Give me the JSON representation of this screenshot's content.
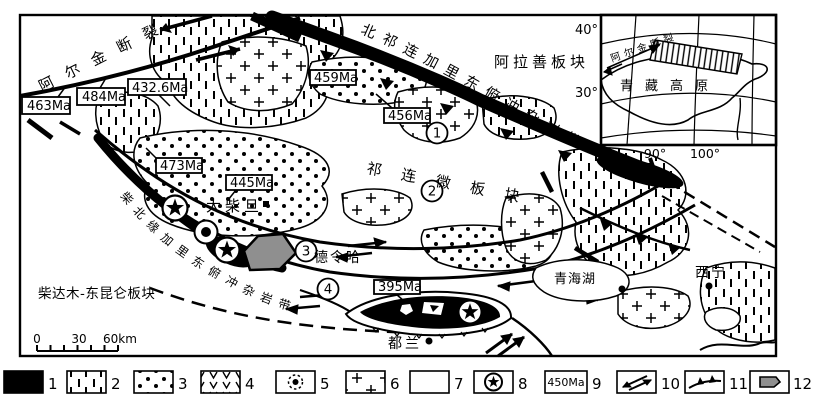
{
  "map": {
    "faults": {
      "altyn_label": "阿尔金断裂",
      "north_qilian_label": "北祁连加里东俯冲杂岩带",
      "north_qaidam_label": "柴北缘加里东俯冲杂岩带"
    },
    "plates": {
      "alxa": "阿拉善板块",
      "qilian": "祁连微板块",
      "qaidam_kunlun": "柴达木-东昆仑板块"
    },
    "places": {
      "da_qaidam": "大柴旦",
      "delingha": "德令哈",
      "dulan": "都兰",
      "xining": "西宁",
      "qinghai_lake": "青海湖"
    },
    "age_labels": {
      "a463": "463Ma",
      "a484": "484Ma",
      "a432_6": "432.6Ma",
      "a459": "459Ma",
      "a456": "456Ma",
      "a473": "473Ma",
      "a445": "445Ma",
      "a395": "395Ma"
    },
    "zones": {
      "z1": "1",
      "z2": "2",
      "z3": "3",
      "z4": "4"
    },
    "scale_bar": {
      "t0": "0",
      "t30": "30",
      "t60": "60km"
    }
  },
  "inset": {
    "fault_label": "阿尔金断裂",
    "plateau_label": "青藏高原",
    "lat_top": "40°",
    "lat_mid": "30°",
    "lon_left": "90°",
    "lon_right": "100°"
  },
  "legend": {
    "nums": [
      "1",
      "2",
      "3",
      "4",
      "5",
      "6",
      "7",
      "8",
      "9",
      "10",
      "11",
      "12"
    ],
    "age_sample": "450Ma"
  },
  "colors": {
    "black": "#000000",
    "white": "#ffffff",
    "gray": "#8f8f8f"
  }
}
